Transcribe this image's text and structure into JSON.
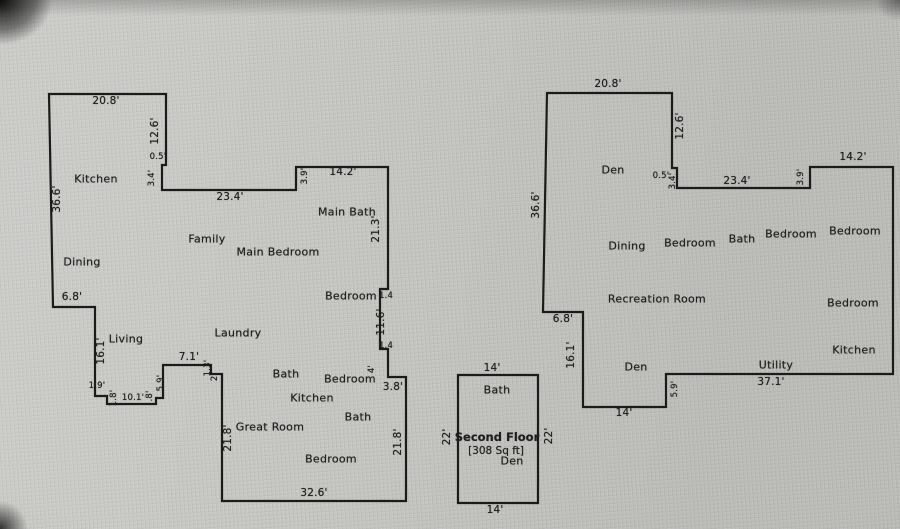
{
  "colors": {
    "background": "#c6c7c3",
    "wall": "#1b1b1b",
    "text": "#1f1f1f"
  },
  "p1": {
    "name": "Main floor plan (left)",
    "dims": [
      "20.8'",
      "12.6'",
      "0.5'",
      "3.4'",
      "36.6'",
      "23.4'",
      "3.9'",
      "14.2'",
      "21.3'",
      "6.8'",
      "1.4",
      "11.6'",
      "1.4",
      "16.1'",
      "7.1'",
      "4'",
      "3.8'",
      "1.9'",
      "5.9'",
      "10.1'",
      "1.8'",
      ".8'",
      "1.3'",
      "2'",
      "21.8'",
      "21.8'",
      "32.6'"
    ],
    "rooms": [
      "Kitchen",
      "Dining",
      "Family",
      "Main Bedroom",
      "Main Bath",
      "Bedroom",
      "Living",
      "Laundry",
      "Bath",
      "Bedroom",
      "Kitchen",
      "Bath",
      "Great Room",
      "Bedroom"
    ]
  },
  "p2": {
    "name": "Second floor plan (middle)",
    "title": "Second Floor",
    "area": "[308 Sq ft]",
    "dims": [
      "14'",
      "22'",
      "22'",
      "14'"
    ],
    "rooms": [
      "Bath",
      "Den"
    ]
  },
  "p3": {
    "name": "Basement floor plan (right)",
    "dims": [
      "20.8'",
      "12.6'",
      "0.5'",
      "3.4'",
      "23.4'",
      "3.9'",
      "14.2'",
      "36.6'",
      "6.8'",
      "16.1'",
      "14'",
      "5.9'",
      "37.1'"
    ],
    "rooms": [
      "Den",
      "Dining",
      "Bedroom",
      "Bath",
      "Bedroom",
      "Bedroom",
      "Recreation Room",
      "Bedroom",
      "Kitchen",
      "Den",
      "Utility"
    ]
  }
}
